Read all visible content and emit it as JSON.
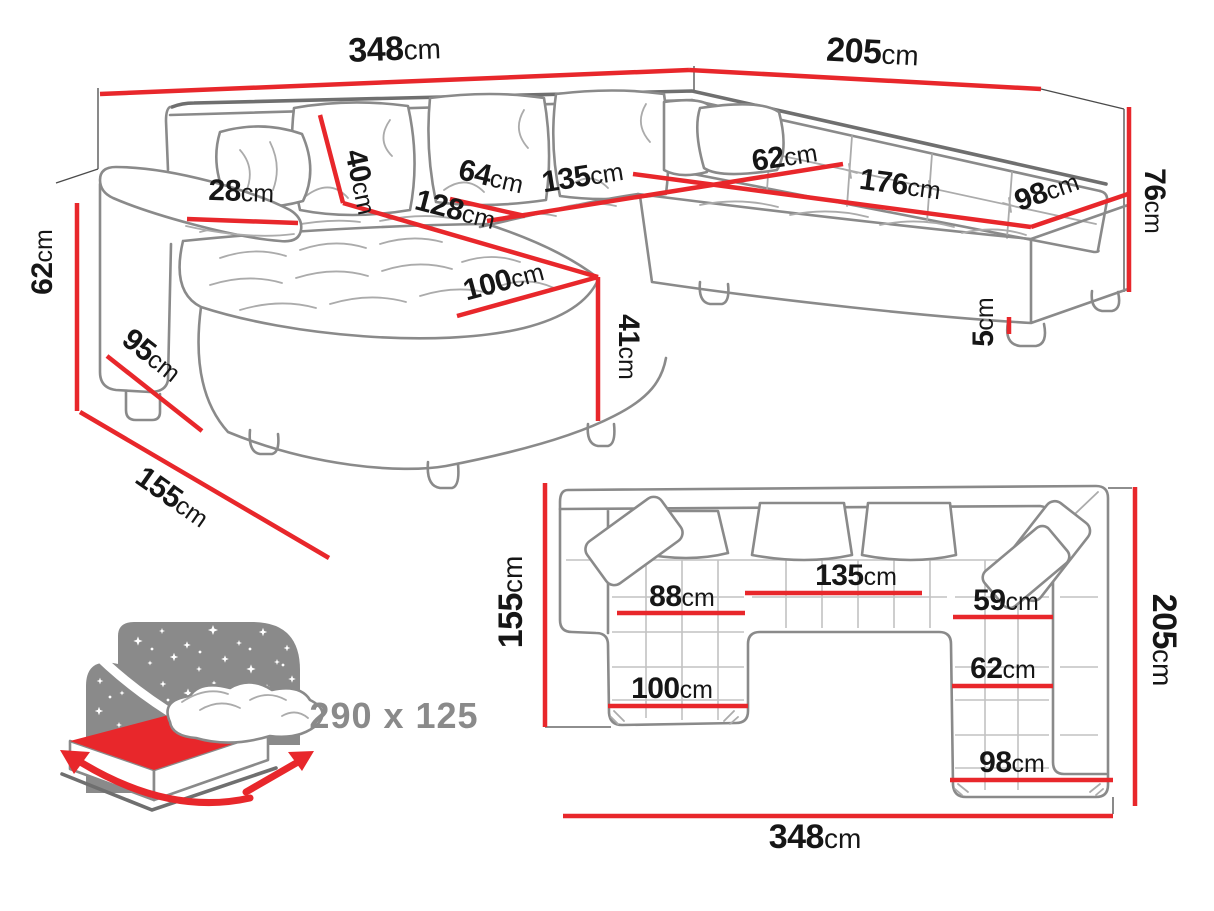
{
  "title": "Corner sofa bed dimensions diagram",
  "unit": "cm",
  "colors": {
    "dimension_red": "#e8272b",
    "outline_gray": "#8a8a8a",
    "text_black": "#161616",
    "muted_gray": "#8a8a8a"
  },
  "perspective": {
    "width_left": {
      "num": "348",
      "unit": "cm"
    },
    "width_right": {
      "num": "205",
      "unit": "cm"
    },
    "arm_height": {
      "num": "62",
      "unit": "cm"
    },
    "arm_depth": {
      "num": "95",
      "unit": "cm"
    },
    "side_depth": {
      "num": "155",
      "unit": "cm"
    },
    "armrest_width": {
      "num": "28",
      "unit": "cm"
    },
    "back_pillow_height": {
      "num": "40",
      "unit": "cm"
    },
    "seat_depth_64": {
      "num": "64",
      "unit": "cm"
    },
    "seat_width_135": {
      "num": "135",
      "unit": "cm"
    },
    "chaise_length_128": {
      "num": "128",
      "unit": "cm"
    },
    "chaise_width_100": {
      "num": "100",
      "unit": "cm"
    },
    "seat_height_41": {
      "num": "41",
      "unit": "cm"
    },
    "corner_seat_62": {
      "num": "62",
      "unit": "cm"
    },
    "right_seat_176": {
      "num": "176",
      "unit": "cm"
    },
    "right_width_98": {
      "num": "98",
      "unit": "cm"
    },
    "back_height_76": {
      "num": "76",
      "unit": "cm"
    },
    "leg_height_5": {
      "num": "5",
      "unit": "cm"
    }
  },
  "plan": {
    "left_depth": {
      "num": "155",
      "unit": "cm"
    },
    "right_depth": {
      "num": "205",
      "unit": "cm"
    },
    "total_width": {
      "num": "348",
      "unit": "cm"
    },
    "seat_88": {
      "num": "88",
      "unit": "cm"
    },
    "seat_135": {
      "num": "135",
      "unit": "cm"
    },
    "seat_59": {
      "num": "59",
      "unit": "cm"
    },
    "chaise_100": {
      "num": "100",
      "unit": "cm"
    },
    "seat_62": {
      "num": "62",
      "unit": "cm"
    },
    "seat_98": {
      "num": "98",
      "unit": "cm"
    }
  },
  "sleeping": {
    "size_label": "290 x 125",
    "icon": "bed-sleeping-function-icon"
  }
}
